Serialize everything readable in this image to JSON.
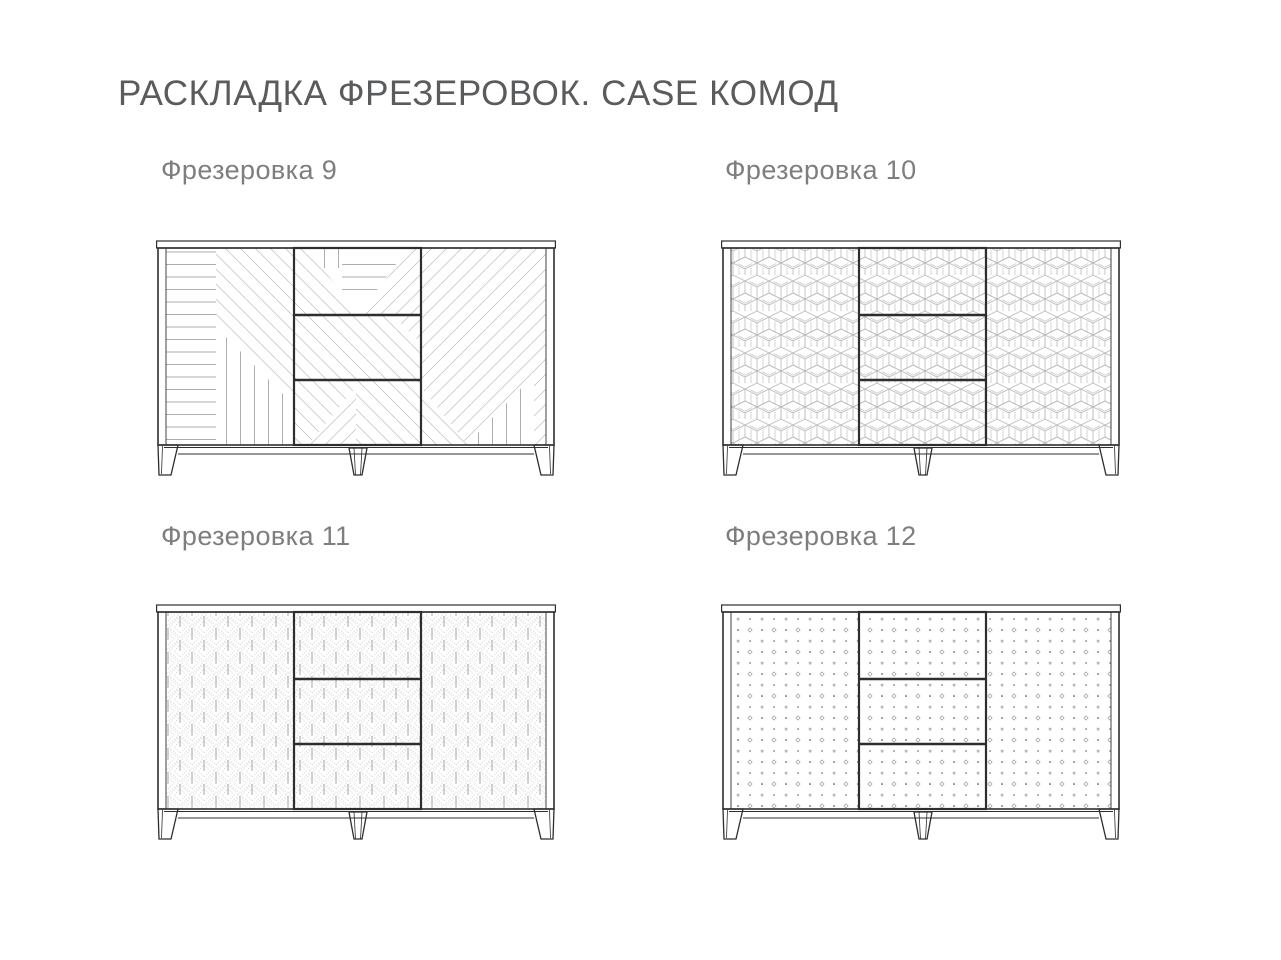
{
  "page": {
    "title": "РАСКЛАДКА ФРЕЗЕРОВОК. CASE КОМОД"
  },
  "variants": [
    {
      "id": "9",
      "label": "Фрезеровка 9",
      "pattern": "diagonal-plank-composition"
    },
    {
      "id": "10",
      "label": "Фрезеровка 10",
      "pattern": "isometric-cube"
    },
    {
      "id": "11",
      "label": "Фрезеровка 11",
      "pattern": "art-deco-diamond-leaf"
    },
    {
      "id": "12",
      "label": "Фрезеровка 12",
      "pattern": "dot-grid"
    }
  ],
  "colors": {
    "background": "#ffffff",
    "title_text": "#5a5b5d",
    "label_text": "#7d7e80",
    "outline": "#2e2e2e",
    "pattern_light": "#c9c9c9",
    "pattern_mid": "#a5a5a5"
  }
}
